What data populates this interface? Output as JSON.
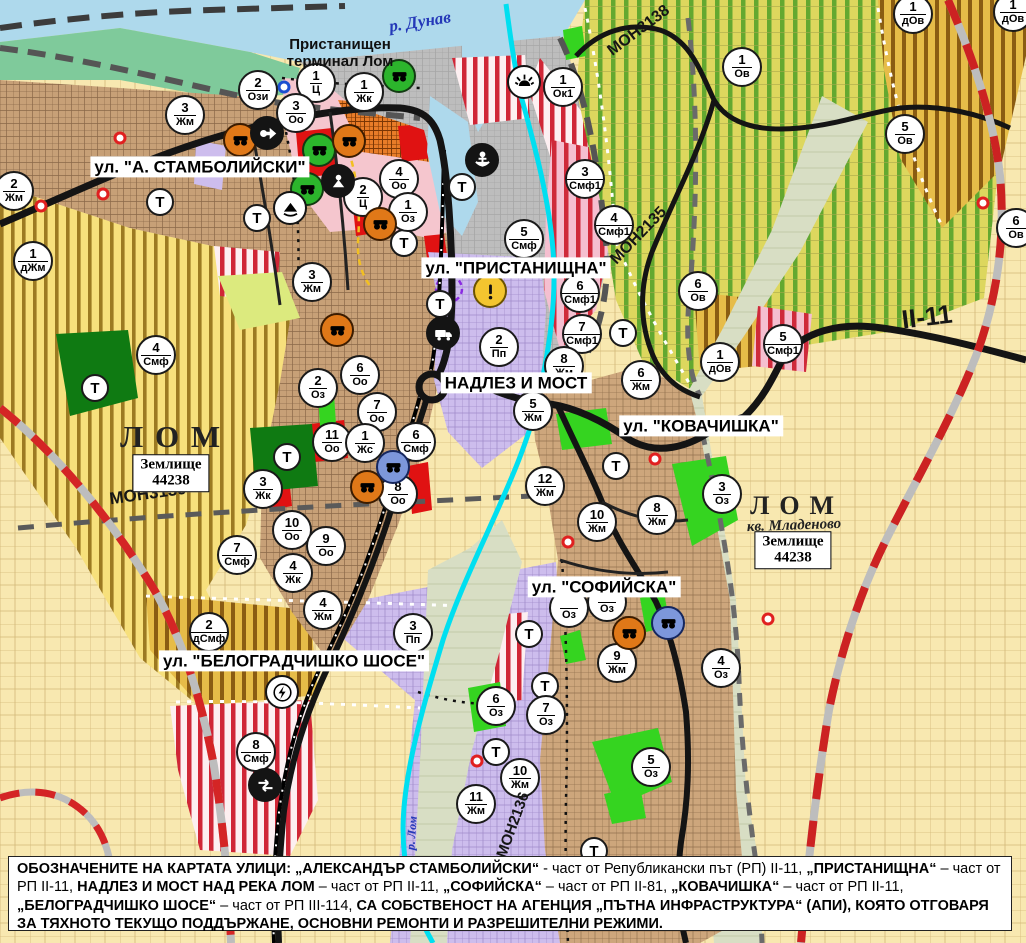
{
  "palette": {
    "water": "#aed9ec",
    "urban_tan": "#c7a077",
    "industrial_purple": "#cdbded",
    "vineyard": "#ddd75e",
    "farm_cream": "#f8e8b0",
    "stripe_red": "#d02636",
    "stripe_gold": "#8a5c12",
    "park_green": "#35d420",
    "road_black": "#141414",
    "river_cyan": "#00dff0",
    "rail_red": "#d42525"
  },
  "street_labels": [
    {
      "id": "stambolijski",
      "text": "ул. \"А. СТАМБОЛИЙСКИ\"",
      "x": 200,
      "y": 167,
      "size": 17
    },
    {
      "id": "pristanishtna",
      "text": "ул. \"ПРИСТАНИЩНА\"",
      "x": 516,
      "y": 268,
      "size": 17
    },
    {
      "id": "nadlez-i-most",
      "text": "НАДЛЕЗ И МОСТ",
      "x": 516,
      "y": 383,
      "size": 17
    },
    {
      "id": "kovachishka",
      "text": "ул. \"КОВАЧИШКА\"",
      "x": 701,
      "y": 426,
      "size": 17
    },
    {
      "id": "sofiyska",
      "text": "ул. \"СОФИЙСКА\"",
      "x": 604,
      "y": 587,
      "size": 17
    },
    {
      "id": "belogradchishko",
      "text": "ул. \"БЕЛОГРАДЧИШКО ШОСЕ\"",
      "x": 294,
      "y": 661,
      "size": 17
    }
  ],
  "place_labels": [
    {
      "id": "danube",
      "kind": "water",
      "text": "р. Дунав",
      "x": 420,
      "y": 22,
      "rot": -9,
      "size": 17
    },
    {
      "id": "port-terminal",
      "kind": "terminal",
      "text": "Пристанищен\nтерминал Лом",
      "x": 340,
      "y": 54,
      "rot": 0,
      "size": 15
    },
    {
      "id": "lom-city-west",
      "kind": "city",
      "text": "ЛОМ",
      "x": 176,
      "y": 437,
      "rot": 0,
      "size": 31
    },
    {
      "id": "lom-city-east",
      "kind": "city",
      "text": "ЛОМ",
      "x": 797,
      "y": 506,
      "rot": 0,
      "size": 26
    },
    {
      "id": "mladenovo",
      "kind": "quarter",
      "text": "кв. Младеново",
      "x": 794,
      "y": 526,
      "rot": -2,
      "size": 15
    },
    {
      "id": "lom-river",
      "kind": "water-small",
      "text": "р. Лом",
      "x": 412,
      "y": 833,
      "rot": -86,
      "size": 12
    }
  ],
  "road_labels": [
    {
      "id": "mon3138",
      "text": "МОН3138",
      "x": 639,
      "y": 31,
      "rot": -37,
      "size": 16
    },
    {
      "id": "mon2135",
      "text": "МОН2135",
      "x": 639,
      "y": 236,
      "rot": -46,
      "size": 16
    },
    {
      "id": "mon3139",
      "text": "МОН3139",
      "x": 148,
      "y": 494,
      "rot": -8,
      "size": 17
    },
    {
      "id": "mon2136",
      "text": "МОН2136",
      "x": 513,
      "y": 825,
      "rot": -70,
      "size": 15
    },
    {
      "id": "ii-11",
      "text": "II-11",
      "x": 927,
      "y": 317,
      "rot": -7,
      "size": 26
    }
  ],
  "area_boxes": [
    {
      "line1": "Землище",
      "line2": "44238",
      "x": 171,
      "y": 473
    },
    {
      "line1": "Землище",
      "line2": "44238",
      "x": 793,
      "y": 550
    }
  ],
  "zone_markers": [
    {
      "n": "2",
      "c": "Ози",
      "x": 258,
      "y": 90
    },
    {
      "n": "1",
      "c": "Ц",
      "x": 316,
      "y": 83
    },
    {
      "n": "3",
      "c": "Оо",
      "x": 296,
      "y": 113
    },
    {
      "n": "1",
      "c": "Жк",
      "x": 364,
      "y": 92
    },
    {
      "n": "1",
      "c": "Ок1",
      "x": 563,
      "y": 87
    },
    {
      "n": "1",
      "c": "Ов",
      "x": 742,
      "y": 67
    },
    {
      "n": "1",
      "c": "дОв",
      "x": 913,
      "y": 14
    },
    {
      "n": "1",
      "c": "дОв",
      "x": 1013,
      "y": 12
    },
    {
      "n": "5",
      "c": "Ов",
      "x": 905,
      "y": 134
    },
    {
      "n": "6",
      "c": "Ов",
      "x": 1016,
      "y": 228
    },
    {
      "n": "3",
      "c": "Жм",
      "x": 185,
      "y": 115
    },
    {
      "n": "2",
      "c": "Жм",
      "x": 14,
      "y": 191
    },
    {
      "n": "1",
      "c": "дЖм",
      "x": 33,
      "y": 261
    },
    {
      "n": "4",
      "c": "Оо",
      "x": 399,
      "y": 179
    },
    {
      "n": "2",
      "c": "Ц",
      "x": 363,
      "y": 197
    },
    {
      "n": "1",
      "c": "Оз",
      "x": 408,
      "y": 212
    },
    {
      "n": "3",
      "c": "Жм",
      "x": 312,
      "y": 282
    },
    {
      "n": "5",
      "c": "Смф",
      "x": 524,
      "y": 239
    },
    {
      "n": "3",
      "c": "Смф1",
      "x": 585,
      "y": 179
    },
    {
      "n": "4",
      "c": "Смф1",
      "x": 614,
      "y": 225
    },
    {
      "n": "6",
      "c": "Смф1",
      "x": 580,
      "y": 293
    },
    {
      "n": "7",
      "c": "Смф1",
      "x": 582,
      "y": 334
    },
    {
      "n": "2",
      "c": "Пп",
      "x": 499,
      "y": 347
    },
    {
      "n": "8",
      "c": "Жм",
      "x": 564,
      "y": 366
    },
    {
      "n": "6",
      "c": "Жм",
      "x": 641,
      "y": 380
    },
    {
      "n": "5",
      "c": "Жм",
      "x": 533,
      "y": 411
    },
    {
      "n": "12",
      "c": "Жм",
      "x": 545,
      "y": 486
    },
    {
      "n": "6",
      "c": "Ов",
      "x": 698,
      "y": 291
    },
    {
      "n": "5",
      "c": "Смф1",
      "x": 783,
      "y": 344
    },
    {
      "n": "1",
      "c": "дОв",
      "x": 720,
      "y": 362
    },
    {
      "n": "4",
      "c": "Смф",
      "x": 156,
      "y": 355
    },
    {
      "n": "2",
      "c": "Оз",
      "x": 318,
      "y": 388
    },
    {
      "n": "6",
      "c": "Оо",
      "x": 360,
      "y": 375
    },
    {
      "n": "7",
      "c": "Оо",
      "x": 377,
      "y": 412
    },
    {
      "n": "11",
      "c": "Оо",
      "x": 332,
      "y": 442
    },
    {
      "n": "1",
      "c": "Жс",
      "x": 365,
      "y": 443
    },
    {
      "n": "6",
      "c": "Смф",
      "x": 416,
      "y": 442
    },
    {
      "n": "8",
      "c": "Оо",
      "x": 398,
      "y": 494
    },
    {
      "n": "3",
      "c": "Жк",
      "x": 263,
      "y": 489
    },
    {
      "n": "10",
      "c": "Оо",
      "x": 292,
      "y": 530
    },
    {
      "n": "9",
      "c": "Оо",
      "x": 326,
      "y": 546
    },
    {
      "n": "4",
      "c": "Жк",
      "x": 293,
      "y": 573
    },
    {
      "n": "7",
      "c": "Смф",
      "x": 237,
      "y": 555
    },
    {
      "n": "2",
      "c": "дСмф",
      "x": 209,
      "y": 632
    },
    {
      "n": "4",
      "c": "Жм",
      "x": 323,
      "y": 610
    },
    {
      "n": "3",
      "c": "Пп",
      "x": 413,
      "y": 633
    },
    {
      "n": "8",
      "c": "Смф",
      "x": 256,
      "y": 752
    },
    {
      "n": "8",
      "c": "Жм",
      "x": 657,
      "y": 515
    },
    {
      "n": "10",
      "c": "Жм",
      "x": 597,
      "y": 522
    },
    {
      "n": "3",
      "c": "Оз",
      "x": 722,
      "y": 494
    },
    {
      "n": "9",
      "c": "Жм",
      "x": 617,
      "y": 663
    },
    {
      "n": "4",
      "c": "Оз",
      "x": 721,
      "y": 668
    },
    {
      "n": "6",
      "c": "Оз",
      "x": 496,
      "y": 706
    },
    {
      "n": "7",
      "c": "Оз",
      "x": 546,
      "y": 715
    },
    {
      "n": "5",
      "c": "Оз",
      "x": 651,
      "y": 767
    },
    {
      "n": "10",
      "c": "Жм",
      "x": 520,
      "y": 778
    },
    {
      "n": "11",
      "c": "Жм",
      "x": 476,
      "y": 804
    },
    {
      "n": "",
      "c": "Оз",
      "x": 569,
      "y": 608
    },
    {
      "n": "",
      "c": "Оз",
      "x": 607,
      "y": 602
    }
  ],
  "transport_markers": [
    {
      "x": 160,
      "y": 202
    },
    {
      "x": 257,
      "y": 218
    },
    {
      "x": 404,
      "y": 243
    },
    {
      "x": 462,
      "y": 187
    },
    {
      "x": 440,
      "y": 304
    },
    {
      "x": 623,
      "y": 333
    },
    {
      "x": 95,
      "y": 388
    },
    {
      "x": 287,
      "y": 457
    },
    {
      "x": 616,
      "y": 466
    },
    {
      "x": 529,
      "y": 634
    },
    {
      "x": 545,
      "y": 686
    },
    {
      "x": 496,
      "y": 752
    },
    {
      "x": 594,
      "y": 851
    }
  ],
  "icon_markers": [
    {
      "type": "monument",
      "variant": "green",
      "x": 399,
      "y": 76
    },
    {
      "type": "monument",
      "variant": "green",
      "x": 319,
      "y": 150
    },
    {
      "type": "monument",
      "variant": "green",
      "x": 307,
      "y": 189
    },
    {
      "type": "monument",
      "variant": "orange",
      "x": 240,
      "y": 140
    },
    {
      "type": "monument",
      "variant": "orange",
      "x": 349,
      "y": 141
    },
    {
      "type": "monument",
      "variant": "orange",
      "x": 380,
      "y": 224
    },
    {
      "type": "monument",
      "variant": "orange",
      "x": 337,
      "y": 330
    },
    {
      "type": "monument",
      "variant": "orange",
      "x": 367,
      "y": 487
    },
    {
      "type": "monument",
      "variant": "orange",
      "x": 629,
      "y": 633
    },
    {
      "type": "monument",
      "variant": "blue",
      "x": 393,
      "y": 467
    },
    {
      "type": "monument",
      "variant": "blue",
      "x": 668,
      "y": 623
    },
    {
      "type": "arrow",
      "variant": "black",
      "x": 267,
      "y": 133
    },
    {
      "type": "person",
      "variant": "black",
      "x": 338,
      "y": 181
    },
    {
      "type": "mountain",
      "variant": "white",
      "x": 290,
      "y": 208
    },
    {
      "type": "anchor",
      "variant": "black",
      "x": 482,
      "y": 160
    },
    {
      "type": "sun",
      "variant": "white",
      "x": 524,
      "y": 82
    },
    {
      "type": "truck",
      "variant": "black",
      "x": 443,
      "y": 333
    },
    {
      "type": "lightning",
      "variant": "white",
      "x": 282,
      "y": 692
    },
    {
      "type": "interchange",
      "variant": "black",
      "x": 265,
      "y": 785
    },
    {
      "type": "exclaim",
      "variant": "yellow",
      "x": 490,
      "y": 291
    }
  ],
  "dot_markers": [
    {
      "x": 120,
      "y": 138,
      "color": "#e02020"
    },
    {
      "x": 103,
      "y": 194,
      "color": "#e02020"
    },
    {
      "x": 41,
      "y": 206,
      "color": "#e02020"
    },
    {
      "x": 983,
      "y": 203,
      "color": "#e02020"
    },
    {
      "x": 655,
      "y": 459,
      "color": "#e02020"
    },
    {
      "x": 768,
      "y": 619,
      "color": "#e02020"
    },
    {
      "x": 477,
      "y": 761,
      "color": "#e02020"
    },
    {
      "x": 568,
      "y": 542,
      "color": "#e02020"
    },
    {
      "x": 284,
      "y": 87,
      "color": "#1c4fd0"
    }
  ],
  "caption": {
    "segments": [
      {
        "text": "ОБОЗНАЧЕНИТЕ НА КАРТАТА УЛИЦИ: „АЛЕКСАНДЪР СТАМБОЛИЙСКИ“ ",
        "bold": true
      },
      {
        "text": "- част от Републикански път (РП) II-11, ",
        "bold": false
      },
      {
        "text": "„ПРИСТАНИЩНА“",
        "bold": true
      },
      {
        "text": " – част от РП II-11, ",
        "bold": false
      },
      {
        "text": "НАДЛЕЗ И МОСТ НАД РЕКА ЛОМ",
        "bold": true
      },
      {
        "text": " – част от РП II-11, ",
        "bold": false
      },
      {
        "text": "„СОФИЙСКА“",
        "bold": true
      },
      {
        "text": " – част от РП II-81, ",
        "bold": false
      },
      {
        "text": "„КОВАЧИШКА“",
        "bold": true
      },
      {
        "text": " – част от РП II-11, ",
        "bold": false
      },
      {
        "text": "„БЕЛОГРАДЧИШКО ШОСЕ“",
        "bold": true
      },
      {
        "text": " – част от РП III-114, ",
        "bold": false
      },
      {
        "text": "СА СОБСТВЕНОСТ НА АГЕНЦИЯ „ПЪТНА ИНФРАСТРУКТУРА“ (АПИ), КОЯТО ОТГОВАРЯ ЗА ТЯХНОТО ТЕКУЩО ПОДДЪРЖАНЕ, ОСНОВНИ РЕМОНТИ И РАЗРЕШИТЕЛНИ РЕЖИМИ.",
        "bold": true
      }
    ]
  }
}
